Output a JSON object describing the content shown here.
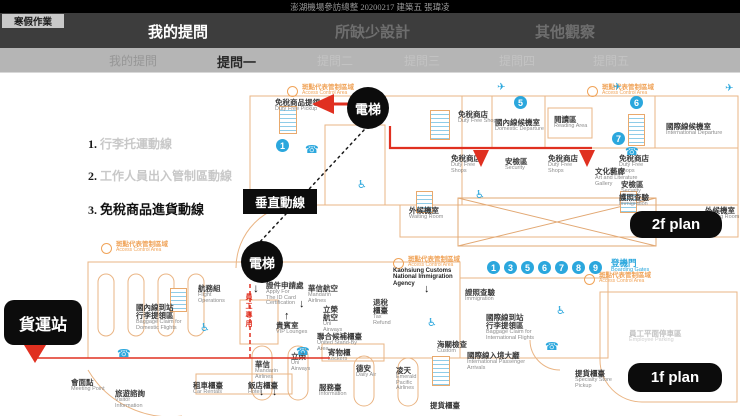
{
  "header": {
    "title": "澎湖機場參訪總整 20200217 建築五 張瑋凌",
    "corner_badge": "寒假作業",
    "tabs": [
      {
        "label": "我的提問"
      },
      {
        "label": "所缺少設計"
      },
      {
        "label": "其他觀察"
      }
    ],
    "subtabs": [
      {
        "label": "我的提問"
      },
      {
        "label": "提問一"
      },
      {
        "label": "提問二"
      },
      {
        "label": "提問三"
      },
      {
        "label": "提問四"
      },
      {
        "label": "提問五"
      }
    ]
  },
  "questions": [
    {
      "num": "1.",
      "text": "行李托運動線"
    },
    {
      "num": "2.",
      "text": "工作人員出入管制區動線"
    },
    {
      "num": "3.",
      "text": "免稅商品進貨動線"
    }
  ],
  "badges": {
    "elevator_2f": "電梯",
    "elevator_1f": "電梯",
    "vertical_line": "垂直動線",
    "cargo_station": "貨運站",
    "plan_2f": "2f plan",
    "plan_1f": "1f plan"
  },
  "legend": {
    "zh": "斑點代表管制區域",
    "en": "Access Control Area"
  },
  "icons": {
    "airplane": "✈",
    "phone": "☎",
    "wheelchair": "♿",
    "arrow_down": "↓",
    "arrow_up": "↑"
  },
  "plan2f": {
    "circles": [
      "1",
      "5",
      "6",
      "7"
    ],
    "labels": [
      {
        "zh": "免稅商品提領",
        "en": "Duty Free Pickup"
      },
      {
        "zh": "免稅商店",
        "en": "Duty Free Shops"
      },
      {
        "zh": "國內線候機室",
        "en": "Domestic Departure"
      },
      {
        "zh": "閱讀區",
        "en": "Reading Area"
      },
      {
        "zh": "國際線候機室",
        "en": "International Departure"
      },
      {
        "zh": "免稅商店",
        "en": "Duty Free\nShops"
      },
      {
        "zh": "安檢區",
        "en": "Security"
      },
      {
        "zh": "免稅商店",
        "en": "Duty Free\nShops"
      },
      {
        "zh": "免稅商店",
        "en": "Duty Free\nShops"
      },
      {
        "zh": "安檢區",
        "en": "Security"
      },
      {
        "zh": "護照查驗",
        "en": "Immigration"
      },
      {
        "zh": "文化藝廊",
        "en": "Art and Literature\nGallery"
      },
      {
        "zh": "外候機室",
        "en": "Waiting Room"
      },
      {
        "zh": "外候機室",
        "en": "Waiting Room"
      },
      {
        "zh": "國際線候機室",
        "en": "International Departure"
      }
    ]
  },
  "plan1f": {
    "gates": {
      "numbers": [
        "1",
        "3",
        "5",
        "6",
        "7",
        "8",
        "9"
      ],
      "zh": "登機門",
      "en": "Boarding Gates"
    },
    "employee_lane": "員工專用",
    "labels": [
      {
        "zh": "航務組",
        "en": "Flight\nOperations"
      },
      {
        "zh": "證件申請處",
        "en": "Apply For\nThe ID Card\nCertification"
      },
      {
        "zh": "華信航空",
        "en": "Mandarin\nAirlines"
      },
      {
        "zh": "立榮\n航空",
        "en": "Uni\nAirways"
      },
      {
        "zh": "貴賓室",
        "en": "VIP Lounges"
      },
      {
        "zh": "國內線到站\n行李提領區",
        "en": "Baggage Claim for\nDomestic Flights"
      },
      {
        "zh": "",
        "en": "Kaohsiung Customs\nNational Immigration\nAgency"
      },
      {
        "zh": "退稅\n櫃臺",
        "en": "Tax\nRefund"
      },
      {
        "zh": "證照查驗",
        "en": "Immigration"
      },
      {
        "zh": "國際線到站\n行李提領區",
        "en": "Baggage Claim for\nInternational Flights"
      },
      {
        "zh": "海關檢查",
        "en": "Custom"
      },
      {
        "zh": "聯合候補櫃臺",
        "en": "United Stand-By\nArea"
      },
      {
        "zh": "寄物櫃",
        "en": "Lockers"
      },
      {
        "zh": "會面點",
        "en": "Meeting Point"
      },
      {
        "zh": "旅遊諮詢",
        "en": "Visitor\nInformation"
      },
      {
        "zh": "租車櫃臺",
        "en": "Car Rentals"
      },
      {
        "zh": "飯店櫃臺",
        "en": "Hotel"
      },
      {
        "zh": "華信",
        "en": "Mandarin\nAirlines"
      },
      {
        "zh": "立榮",
        "en": "Uni\nAirways"
      },
      {
        "zh": "德安",
        "en": "Daily Air"
      },
      {
        "zh": "凌天",
        "en": "Emerald\nPacific\nAirlines"
      },
      {
        "zh": "服務臺",
        "en": "Information"
      },
      {
        "zh": "提貨櫃臺",
        "en": ""
      },
      {
        "zh": "提貨櫃臺",
        "en": "Specialty Store\nPickup"
      },
      {
        "zh": "國際線入境大廳",
        "en": "International Passenger\nArrivals"
      },
      {
        "zh": "員工平面停車區",
        "en": "Employee Parking"
      }
    ]
  }
}
